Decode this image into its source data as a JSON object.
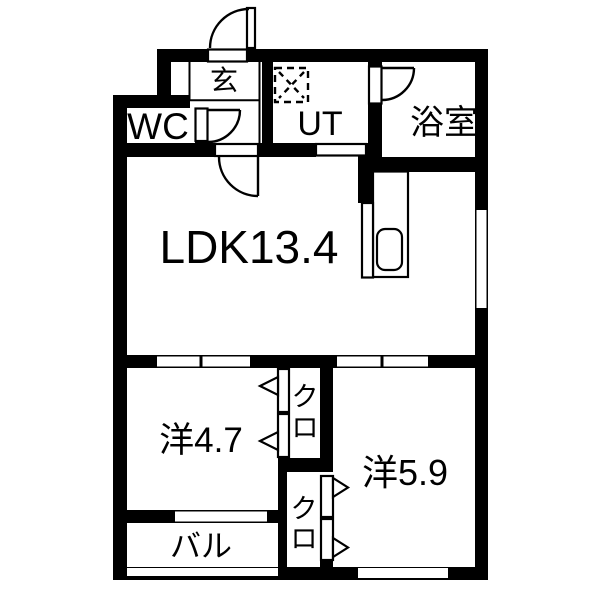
{
  "floorplan": {
    "type": "apartment-floor-plan",
    "colors": {
      "wall": "#000000",
      "floor": "#ffffff",
      "text": "#000000"
    },
    "rooms": {
      "entrance": {
        "label": "玄"
      },
      "wc": {
        "label": "WC"
      },
      "utility": {
        "label": "UT"
      },
      "bathroom": {
        "label": "浴室"
      },
      "ldk": {
        "label": "LDK13.4"
      },
      "bedroom_west": {
        "label": "洋4.7"
      },
      "bedroom_east": {
        "label": "洋5.9"
      },
      "closet_upper": {
        "label": "クロ",
        "char_top": "ク",
        "char_bottom": "ロ"
      },
      "closet_lower": {
        "label": "クロ",
        "char_top": "ク",
        "char_bottom": "ロ"
      },
      "balcony": {
        "label": "バル"
      }
    },
    "icons": {
      "washing_machine": "dashed square with X",
      "kitchen_sink": "rounded rectangle in counter",
      "hinged_door": "quarter-circle swing arc",
      "closet_door": "open triangle arrow",
      "window": "white gap in wall"
    }
  }
}
